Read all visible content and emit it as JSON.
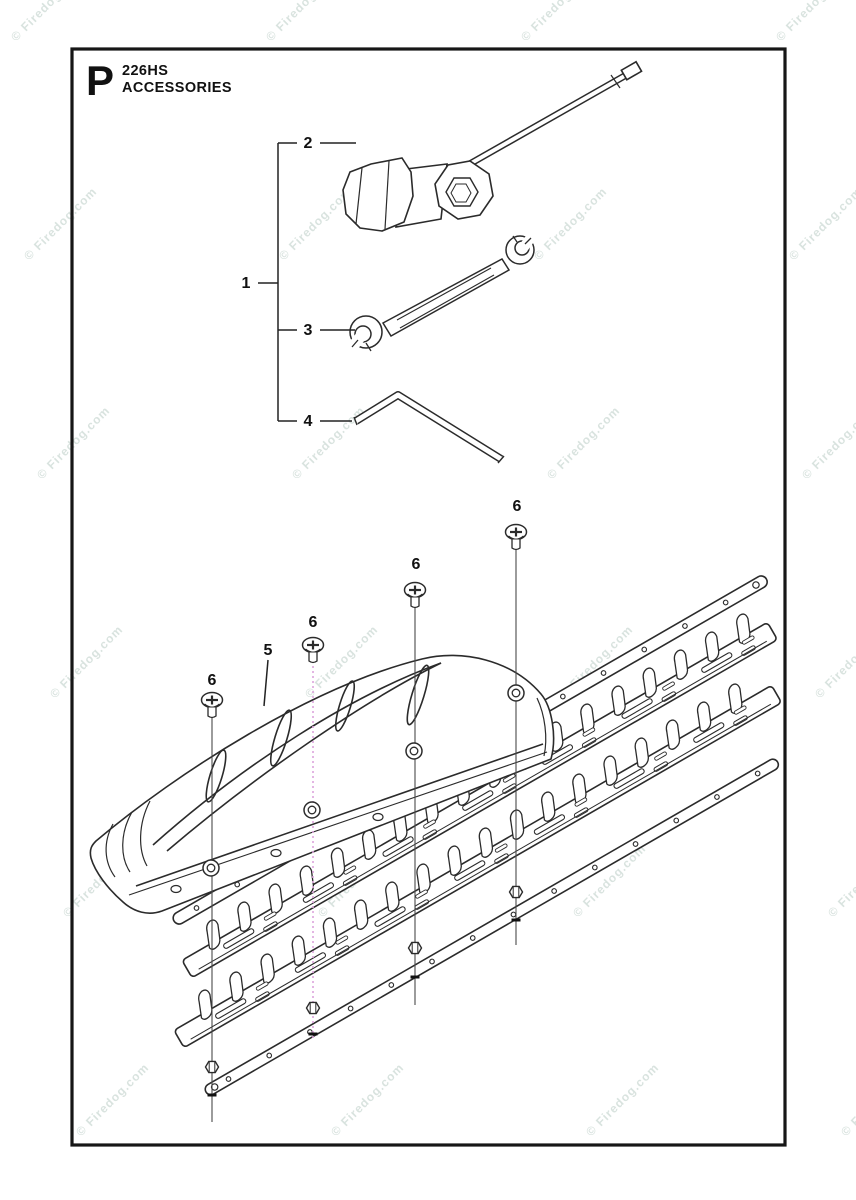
{
  "page": {
    "section_letter": "P",
    "model": "226HS",
    "title": "ACCESSORIES"
  },
  "watermark": {
    "text": "© Firedog.com",
    "color": "#d9e3df"
  },
  "colors": {
    "line": "#2b2b2b",
    "paper": "#ffffff",
    "dotted_leader": "#dca4dc",
    "label": "#111111"
  },
  "callout_numbers": [
    {
      "text": "1",
      "x": 246,
      "y": 288
    },
    {
      "text": "2",
      "x": 308,
      "y": 148
    },
    {
      "text": "3",
      "x": 308,
      "y": 335
    },
    {
      "text": "4",
      "x": 308,
      "y": 426
    },
    {
      "text": "5",
      "x": 268,
      "y": 655
    },
    {
      "text": "6",
      "x": 212,
      "y": 685
    },
    {
      "text": "6",
      "x": 313,
      "y": 627
    },
    {
      "text": "6",
      "x": 416,
      "y": 569
    },
    {
      "text": "6",
      "x": 517,
      "y": 511
    }
  ]
}
